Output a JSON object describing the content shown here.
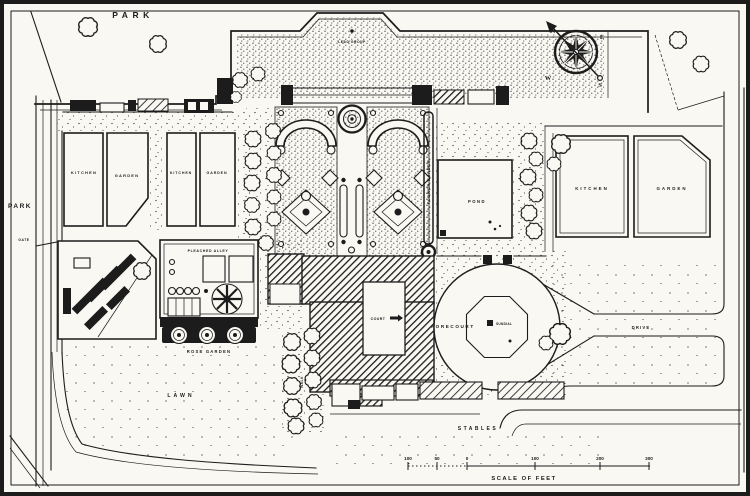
{
  "colors": {
    "paper": "#f9f8f3",
    "ink": "#1c1c1c"
  },
  "labels": {
    "park_top": "PARK",
    "park_left": "PARK",
    "gate": "GATE",
    "lead_group": "LEAD GROUP",
    "kitchen_west_outer_word1": "KITCHEN",
    "kitchen_west_outer_word2": "GARDEN",
    "kitchen_west_inner_word1": "KITCHEN",
    "kitchen_west_inner_word2": "GARDEN",
    "kitchen_east_word1": "KITCHEN",
    "kitchen_east_word2": "GARDEN",
    "pleached_alley_top": "PLEACHED ALLEY",
    "pleached_alley_band": "PLEACHED ALLEY",
    "rose_garden": "ROSE GARDEN",
    "flower_border": "FLOWER BORDER",
    "pond": "POND",
    "court": "COURT",
    "walk": "WALK",
    "forecourt": "FORECOURT",
    "sundial": "SUNDIAL",
    "drive": "DRIVE",
    "lawn": "LAWN",
    "stables": "STABLES"
  },
  "compass": {
    "n": "N",
    "e": "E",
    "w": "W",
    "s": "S"
  },
  "scale_bar": {
    "caption": "SCALE OF FEET",
    "ticks": [
      "100",
      "50",
      "0",
      "100",
      "200",
      "300"
    ]
  }
}
